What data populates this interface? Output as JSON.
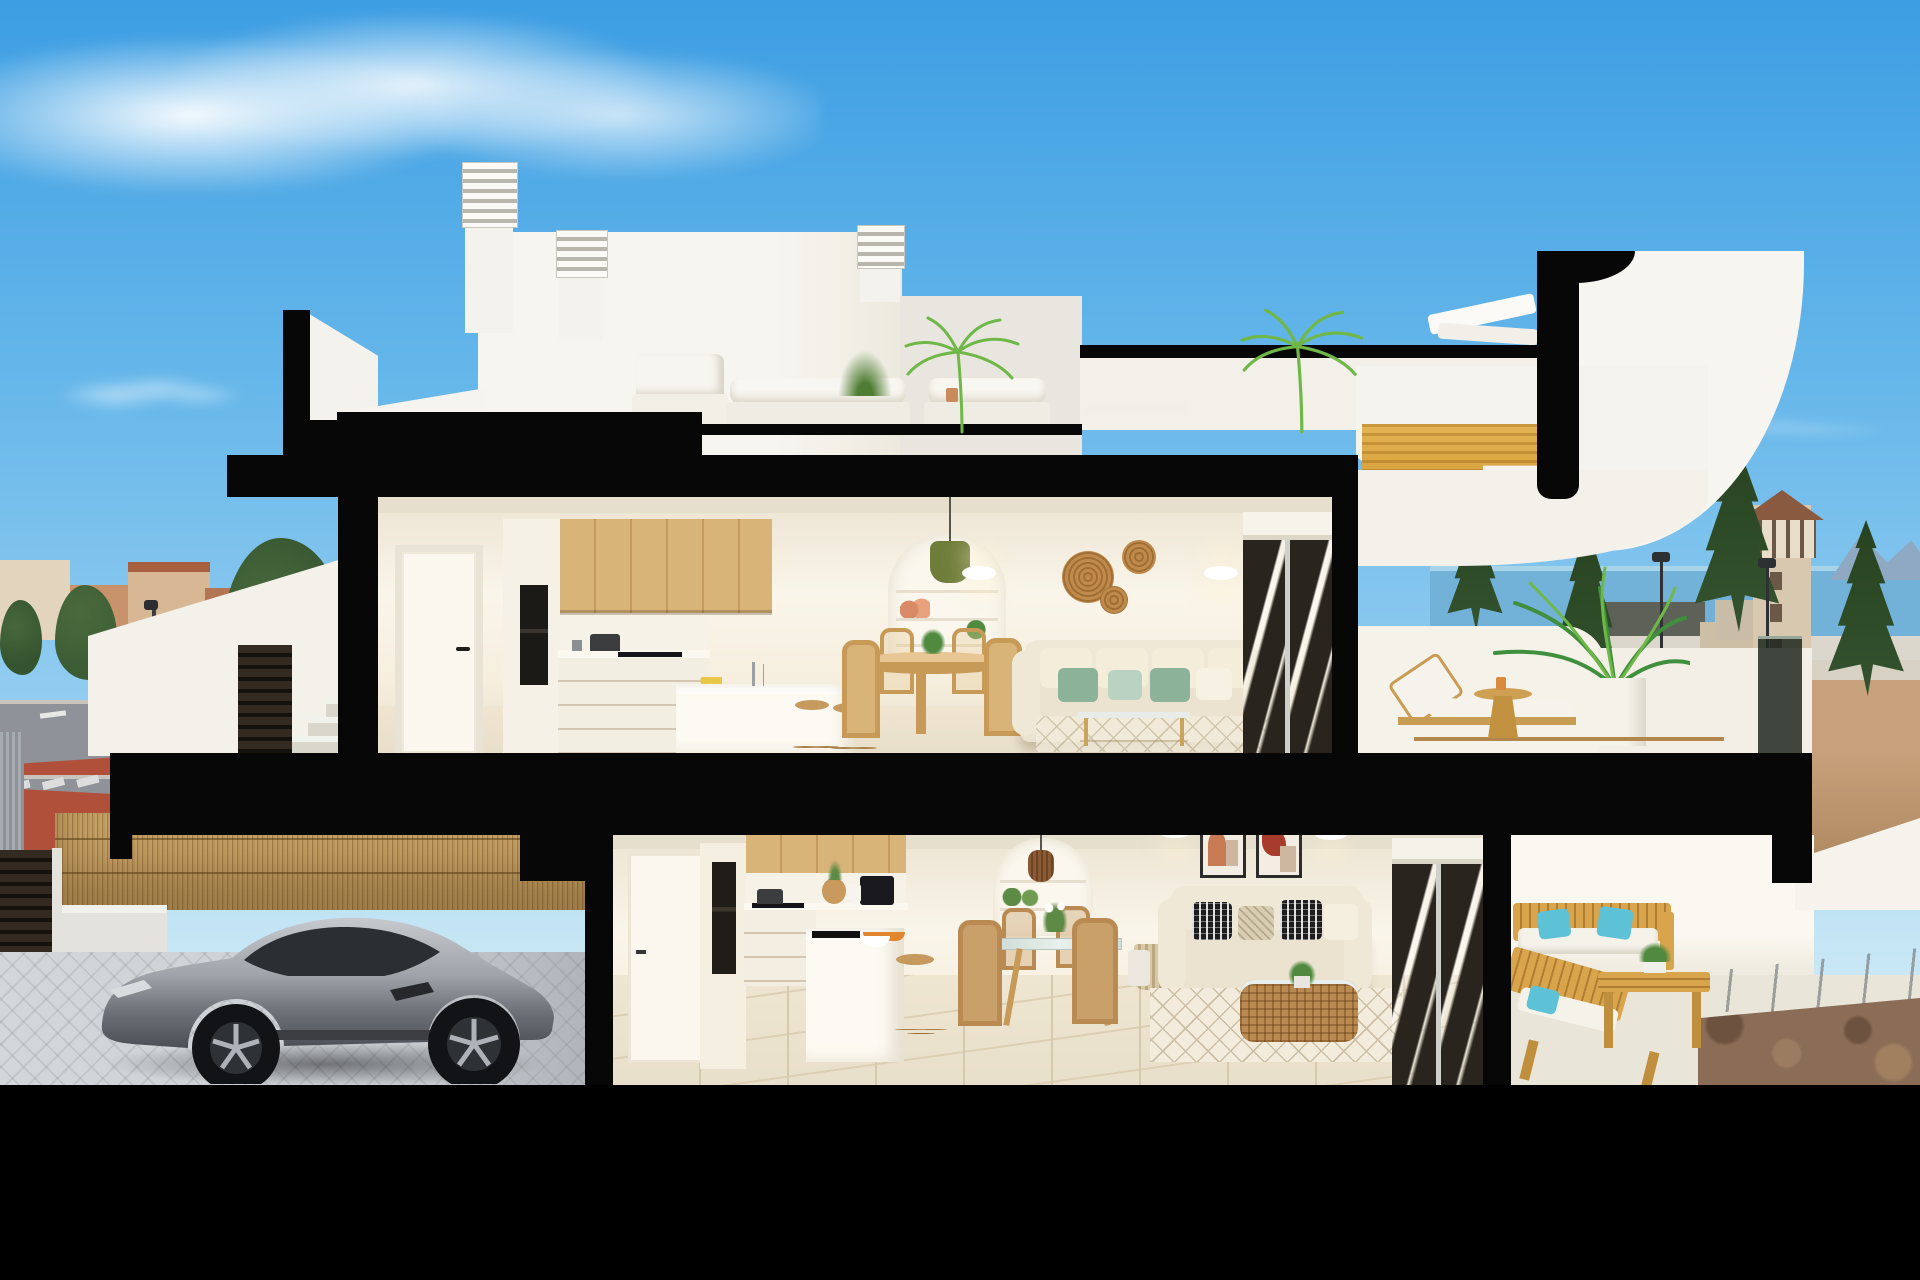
{
  "scene": {
    "type": "architectural-3d-cutaway-render",
    "subject": "Cross-section 3D rendering of a two-storey white coastal townhouse with roof terrace, furnished interiors, garage with silver sports car, town and sea views",
    "time_of_day": "day",
    "visible_text": "none"
  },
  "colors": {
    "skyTop": "#3d9ee3",
    "cloud": "#ffffff",
    "frame": "#070707",
    "whiteVol": "#f4f2ec",
    "whiteVol2": "#e9e6df",
    "louver": "#b9b6ad",
    "intWallLit": "#faf5ea",
    "ceil": "#e6dfce",
    "floorTile": "#e8dfca",
    "wood": "#d8b478",
    "woodDark": "#b98a52",
    "woodStair": "#d29a33",
    "oven": "#1c1a17",
    "counter": "#fbf8f0",
    "nicheWhite": "#fbf7ee",
    "pendantGreen": "#6f7d3a",
    "rattan": "#8a5a33",
    "sconceGlow": "#fff3d2",
    "basket": "#bf8a4b",
    "sofaCream": "#ebe3d0",
    "pillowSage": "#8db29a",
    "pillowMint": "#b9d2c1",
    "glassDark": "#29241d",
    "pillowBW": "#1d1d1d",
    "artTerracotta": "#c87a52",
    "artRed": "#a83c2c",
    "artBeige": "#cdb6a0",
    "rug": "#f3ecdc",
    "rugLine": "#cdbfa5",
    "outWood": "#d8a44c",
    "cushionWhite": "#f5f2ea",
    "pillowTeal": "#5ec2d6",
    "parapet": "#f5f2ea",
    "glassRail": "#252a24",
    "palmGreen": "#3f8f3c",
    "palmLight": "#6fb848",
    "carSilver": "#c6c9ce",
    "carDark": "#4c4f55",
    "carGlass": "#2b2f33",
    "wheel": "#121317",
    "rim": "#aeb2b8",
    "reed": "#c5a168",
    "reedDark": "#a07c46",
    "pavers": "#ccd0d5",
    "gate": "#2a231c",
    "street": "#8f9399",
    "redLane": "#b1503a",
    "sidewalk": "#c5c1b9",
    "signBlue": "#2f6fd0",
    "sea": "#72b2d8",
    "mountain": "#8fa9c2",
    "sand": "#c6a17b",
    "sandRoad": "#d8d2c5",
    "towerBody": "#d8c8b0",
    "towerRoof": "#8a5a40",
    "tree": "#34532f",
    "treeDark": "#27421f",
    "town1": "#c8936b",
    "town2": "#b37654",
    "roofTile": "#a65f3f",
    "townLight": "#e3d4bd",
    "gravel": "#8b6c56"
  },
  "objects": {
    "sky": [
      "wispy-cloud-top-left",
      "faint-cloud-left",
      "faint-wisp-right"
    ],
    "background_left_town": [
      "beige-terracotta-buildings",
      "warehouse",
      "palm-and-pine-trees",
      "gray-street",
      "red-bike-lane",
      "crosswalk",
      "lamppost",
      "blue-round-sign",
      "corrugated-fence"
    ],
    "background_right": [
      "sea-band",
      "mountain-silhouette",
      "sandy-ground",
      "watchtower-with-terracotta-roof",
      "four-conifers",
      "two-lampposts",
      "light-road-band"
    ],
    "roof_level": [
      "white-stair-bulkhead",
      "louvered-chimney-tall",
      "louvered-chimney-short",
      "louvered-chimney-small",
      "white-outdoor-sofas",
      "potted-grass",
      "low-table",
      "two-palm-plants",
      "white-lounger-silhouette",
      "parapet-band"
    ],
    "cut_staircase": [
      "white-curved-sail-volume",
      "golden-wood-stair-section",
      "black-section-cap"
    ],
    "entry_stairs": [
      "white-sloped-parapet",
      "concrete-steps",
      "dark-louver-panel"
    ],
    "upper_floor": [
      "white-door-black-handle",
      "tall-unit-black-double-oven",
      "oak-upper-cabinets",
      "white-counter-with-pot",
      "black-cooktop",
      "white-island-with-faucet-and-lemons",
      "two-wood-stools",
      "round-wood-dining-table-four-chairs",
      "arched-shelf-niche-with-vases-and-plant",
      "green-pendant-lamp",
      "two-oval-wall-sconces",
      "three-rattan-wall-baskets",
      "cream-sofa-sage-green-pillows",
      "glass-coffee-table",
      "light-rug",
      "dark-sliding-glass-door-with-blind"
    ],
    "upper_terrace": [
      "white-curved-parapet",
      "dark-glass-railing",
      "wood-sun-lounger-white-cushion",
      "round-wood-side-table",
      "areca-palm-in-white-cube-planter",
      "street-view-behind"
    ],
    "lower_floor": [
      "hallway-white-door",
      "tall-unit-black-oven",
      "oak-upper-cabinets",
      "black-cooktop-with-pot",
      "black-coffee-machine",
      "rattan-vase-and-jug",
      "white-peninsula-black-sink-orange-fruit-bowl",
      "wood-stool",
      "arched-niche-with-plants",
      "rattan-pendant-lantern",
      "glass-dining-table-wood-legs-four-chairs",
      "flower-centerpiece",
      "storage-basket-with-blanket",
      "beige-sofa-black-white-patterned-pillows",
      "two-abstract-art-frames",
      "two-wall-sconces",
      "rattan-basket-coffee-table-with-plant",
      "white-diamond-pattern-rug",
      "dark-sliding-glass-door"
    ],
    "lower_terrace": [
      "white-back-wall",
      "wood-outdoor-sofa-turquoise-pillows",
      "wood-lounge-chair-turquoise-pillow",
      "slatted-wood-coffee-table-with-plant",
      "concrete-walkway-joints",
      "brown-gravel-bed"
    ],
    "garage": [
      "gray-street-red-lane",
      "reed-bamboo-fence",
      "white-base-wall",
      "dark-louvered-gate",
      "cobblestone-pavers",
      "silver-sports-coupe"
    ],
    "section_frame": [
      "stepped-black-roof-slab",
      "black-columns",
      "black-interfloor-slab",
      "black-base-band"
    ]
  }
}
